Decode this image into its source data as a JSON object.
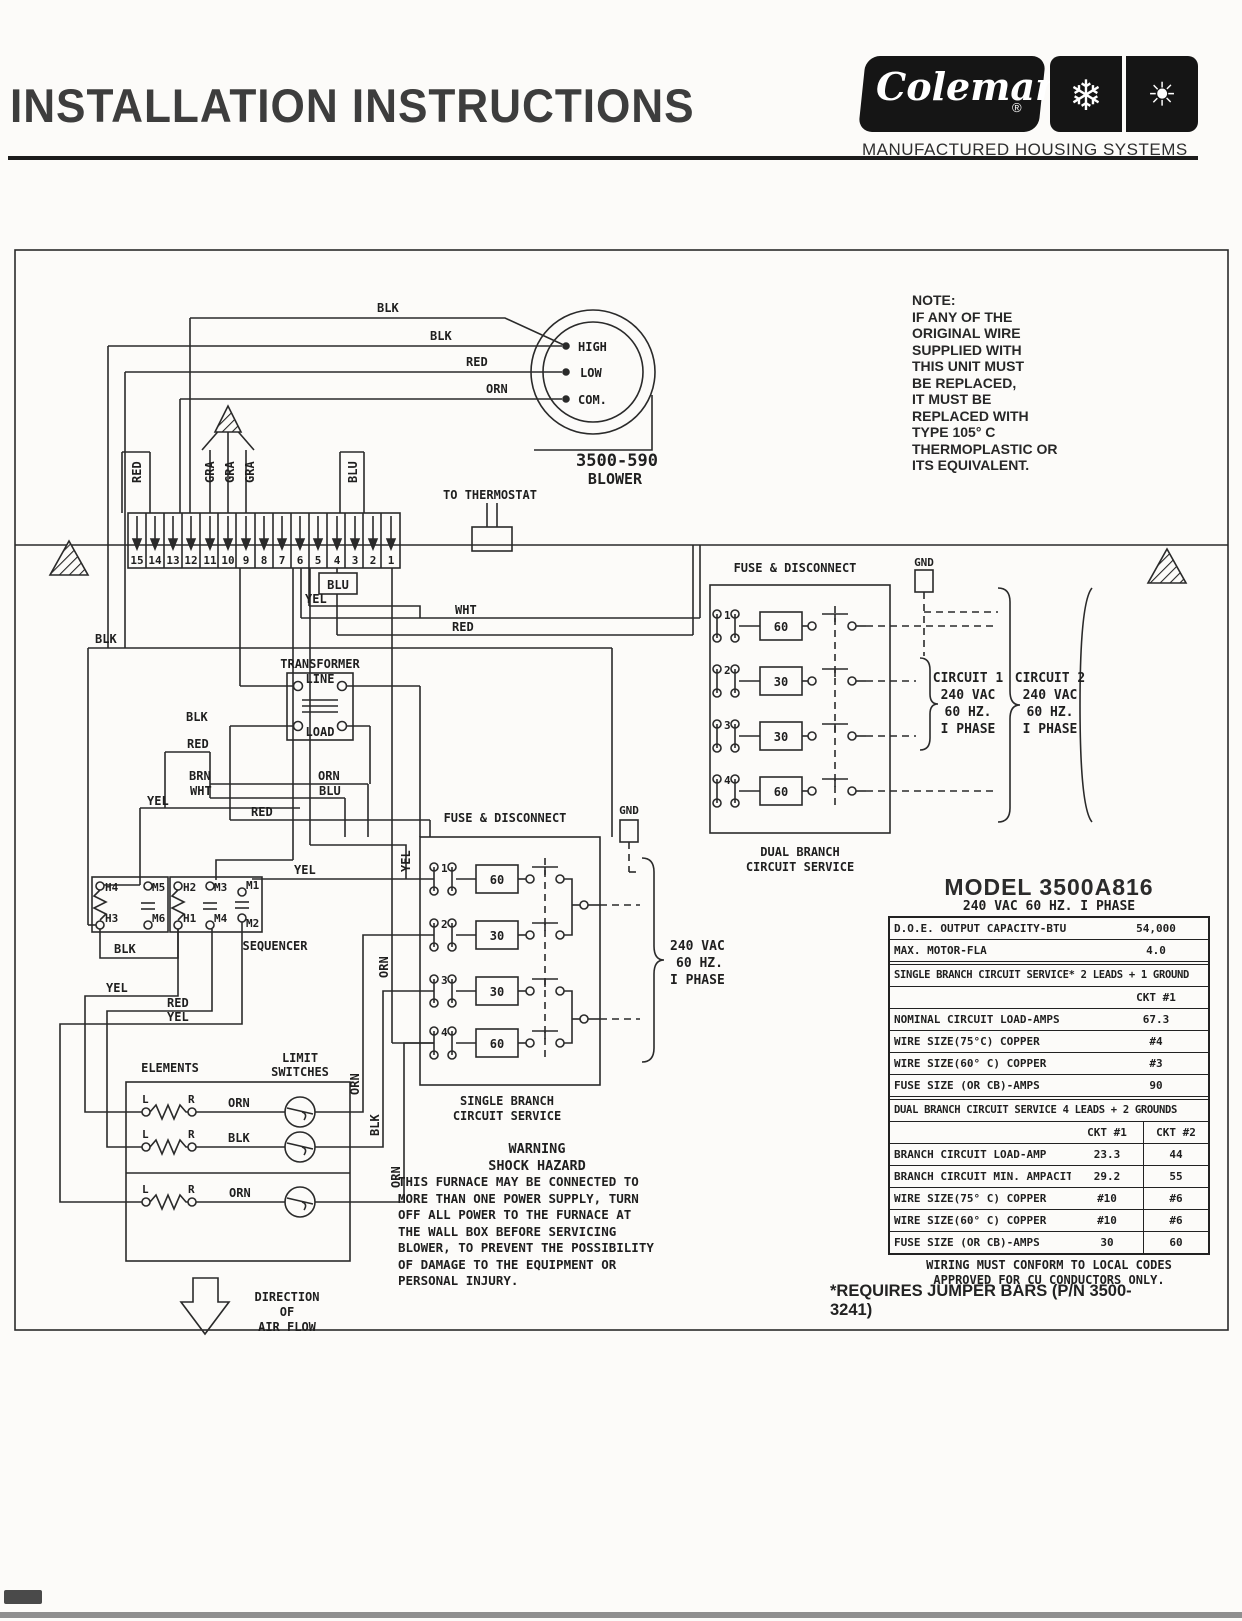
{
  "header": {
    "title": "INSTALLATION  INSTRUCTIONS",
    "brand": "Coleman",
    "brand_reg": "®",
    "brand_sub": "MANUFACTURED HOUSING SYSTEMS",
    "icons": {
      "snowflake": "❄",
      "sun": "☀"
    }
  },
  "note": "NOTE:\nIF ANY OF THE\nORIGINAL WIRE\nSUPPLIED WITH\nTHIS UNIT MUST\nBE REPLACED,\nIT MUST BE\nREPLACED WITH\nTYPE 105° C\nTHERMOPLASTIC OR\nITS EQUIVALENT.",
  "blower": {
    "model": "3500-590",
    "label": "BLOWER",
    "terminals": [
      "HIGH",
      "LOW",
      "COM."
    ]
  },
  "thermostat_label": "TO THERMOSTAT",
  "terminal_strip": {
    "numbers": [
      "15",
      "14",
      "13",
      "12",
      "11",
      "10",
      "9",
      "8",
      "7",
      "6",
      "5",
      "4",
      "3",
      "2",
      "1"
    ]
  },
  "transformer": {
    "title": "TRANSFORMER",
    "line_label": "LINE",
    "load_label": "LOAD"
  },
  "sequencer": {
    "title": "SEQUENCER",
    "t": [
      "H4",
      "M5",
      "H3",
      "M6",
      "H2",
      "M3",
      "H1",
      "M4",
      "M1",
      "M2"
    ]
  },
  "elements": {
    "title": "ELEMENTS",
    "limit1": "LIMIT",
    "limit2": "SWITCHES",
    "l": "L",
    "r": "R"
  },
  "single_branch": {
    "title": "FUSE & DISCONNECT",
    "gnd": "GND",
    "n": [
      "1",
      "2",
      "3",
      "4"
    ],
    "fuses": [
      "60",
      "30",
      "30",
      "60"
    ],
    "rating": [
      "240 VAC",
      "60 HZ.",
      "I PHASE"
    ],
    "cap1": "SINGLE BRANCH",
    "cap2": "CIRCUIT SERVICE"
  },
  "dual_branch": {
    "title": "FUSE & DISCONNECT",
    "gnd": "GND",
    "n": [
      "1",
      "2",
      "3",
      "4"
    ],
    "fuses": [
      "60",
      "30",
      "30",
      "60"
    ],
    "c1": [
      "CIRCUIT 1",
      "240 VAC",
      "60 HZ.",
      "I PHASE"
    ],
    "c2": [
      "CIRCUIT 2",
      "240 VAC",
      "60 HZ.",
      "I PHASE"
    ],
    "cap1": "DUAL BRANCH",
    "cap2": "CIRCUIT SERVICE"
  },
  "warning": {
    "t1": "WARNING",
    "t2": "SHOCK HAZARD",
    "body": "THIS FURNACE MAY BE CONNECTED TO\nMORE THAN ONE POWER SUPPLY, TURN\nOFF ALL POWER TO THE FURNACE AT\nTHE WALL BOX BEFORE SERVICING\nBLOWER, TO PREVENT THE POSSIBILITY\nOF DAMAGE TO THE EQUIPMENT OR\nPERSONAL INJURY."
  },
  "airflow": "DIRECTION\nOF\nAIR FLOW",
  "jumper_note": "*REQUIRES JUMPER BARS (P/N 3500-3241)",
  "spec_table": {
    "title": "MODEL 3500A816",
    "subtitle": "240 VAC 60 HZ. I PHASE",
    "single_rows": [
      [
        "D.O.E. OUTPUT CAPACITY-BTU",
        "54,000"
      ],
      [
        "MAX. MOTOR-FLA",
        "4.0"
      ]
    ],
    "single_header": "SINGLE BRANCH CIRCUIT SERVICE* 2 LEADS + 1 GROUND",
    "ckt1_label": "CKT #1",
    "single_spec_rows": [
      [
        "NOMINAL CIRCUIT LOAD-AMPS",
        "67.3"
      ],
      [
        "WIRE SIZE(75°C)  COPPER",
        "#4"
      ],
      [
        "WIRE SIZE(60° C)  COPPER",
        "#3"
      ],
      [
        "FUSE SIZE (OR CB)-AMPS",
        "90"
      ]
    ],
    "dual_header": "DUAL BRANCH CIRCUIT SERVICE 4 LEADS + 2 GROUNDS",
    "dual_col1": "CKT #1",
    "dual_col2": "CKT #2",
    "dual_rows": [
      [
        "BRANCH CIRCUIT LOAD-AMP",
        "23.3",
        "44"
      ],
      [
        "BRANCH CIRCUIT MIN. AMPACITY",
        "29.2",
        "55"
      ],
      [
        "WIRE SIZE(75° C)  COPPER",
        "#10",
        "#6"
      ],
      [
        "WIRE SIZE(60° C)  COPPER",
        "#10",
        "#6"
      ],
      [
        "FUSE SIZE (OR CB)-AMPS",
        "30",
        "60"
      ]
    ],
    "footer": "WIRING MUST CONFORM TO LOCAL CODES\nAPPROVED FOR CU CONDUCTORS ONLY."
  },
  "wire_labels": [
    "BLK",
    "BLK",
    "RED",
    "ORN",
    "RED",
    "GRA",
    "GRA",
    "GRA",
    "BLU",
    "BLU",
    "YEL",
    "WHT",
    "RED",
    "BLK",
    "BLK",
    "RED",
    "BRN",
    "WHT",
    "ORN",
    "BLU",
    "YEL",
    "RED",
    "YEL",
    "BLK",
    "YEL",
    "RED",
    "YEL",
    "YEL",
    "ORN",
    "ORN",
    "BLK",
    "ORN",
    "ORN",
    "BLK",
    "ORN"
  ]
}
